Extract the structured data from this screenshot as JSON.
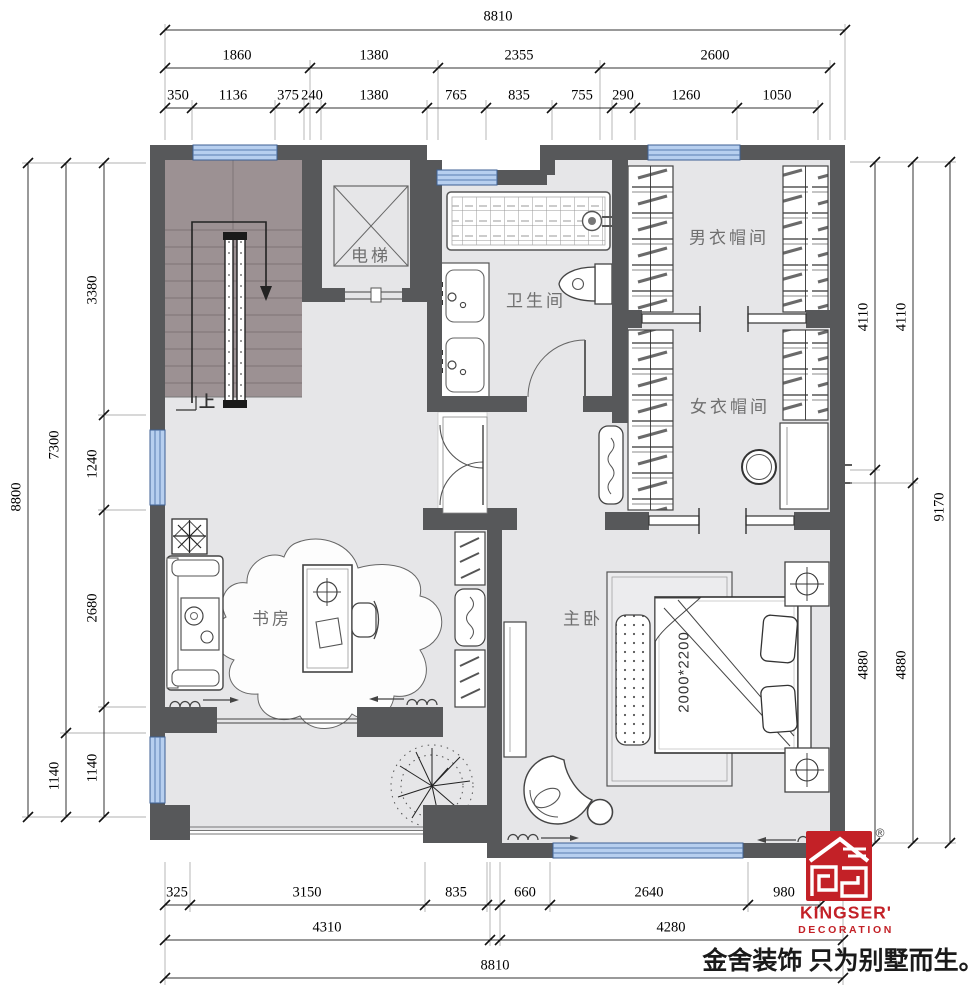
{
  "dimensions": {
    "top": {
      "total": "8810",
      "row2": [
        "1860",
        "1380",
        "2355",
        "2600"
      ],
      "row3": [
        "350",
        "1136",
        "375",
        "240",
        "1380",
        "765",
        "835",
        "755",
        "290",
        "1260",
        "1050"
      ]
    },
    "bottom": {
      "row1": [
        "325",
        "3150",
        "835",
        "660",
        "2640",
        "980"
      ],
      "row2": [
        "4310",
        "4280"
      ],
      "total": "8810"
    },
    "left": {
      "total": "8800",
      "mid": [
        "7300",
        "1140"
      ],
      "inner": [
        "3380",
        "1240",
        "2680",
        "1140"
      ]
    },
    "right": {
      "inner": [
        "4110",
        "4880"
      ],
      "mid": [
        "4110",
        "4880"
      ],
      "total": "9170"
    }
  },
  "rooms": {
    "stairs_up": "上",
    "elevator": "电梯",
    "bathroom": "卫生间",
    "mens_cloakroom": "男衣帽间",
    "womens_cloakroom": "女衣帽间",
    "study": "书房",
    "master_bedroom": "主卧",
    "bed_size": "2000*2200"
  },
  "logo": {
    "brand": "KINGSER'",
    "division": "DECORATION",
    "registered": "®",
    "slogan": "金舍装饰 只为别墅而生。"
  },
  "colors": {
    "wall": "#57585a",
    "floor": "#e6e6e8",
    "stairs": "#9c9193",
    "window_fill": "#b7cfef",
    "window_line": "#5a7db0",
    "brand_red": "#c32127"
  }
}
